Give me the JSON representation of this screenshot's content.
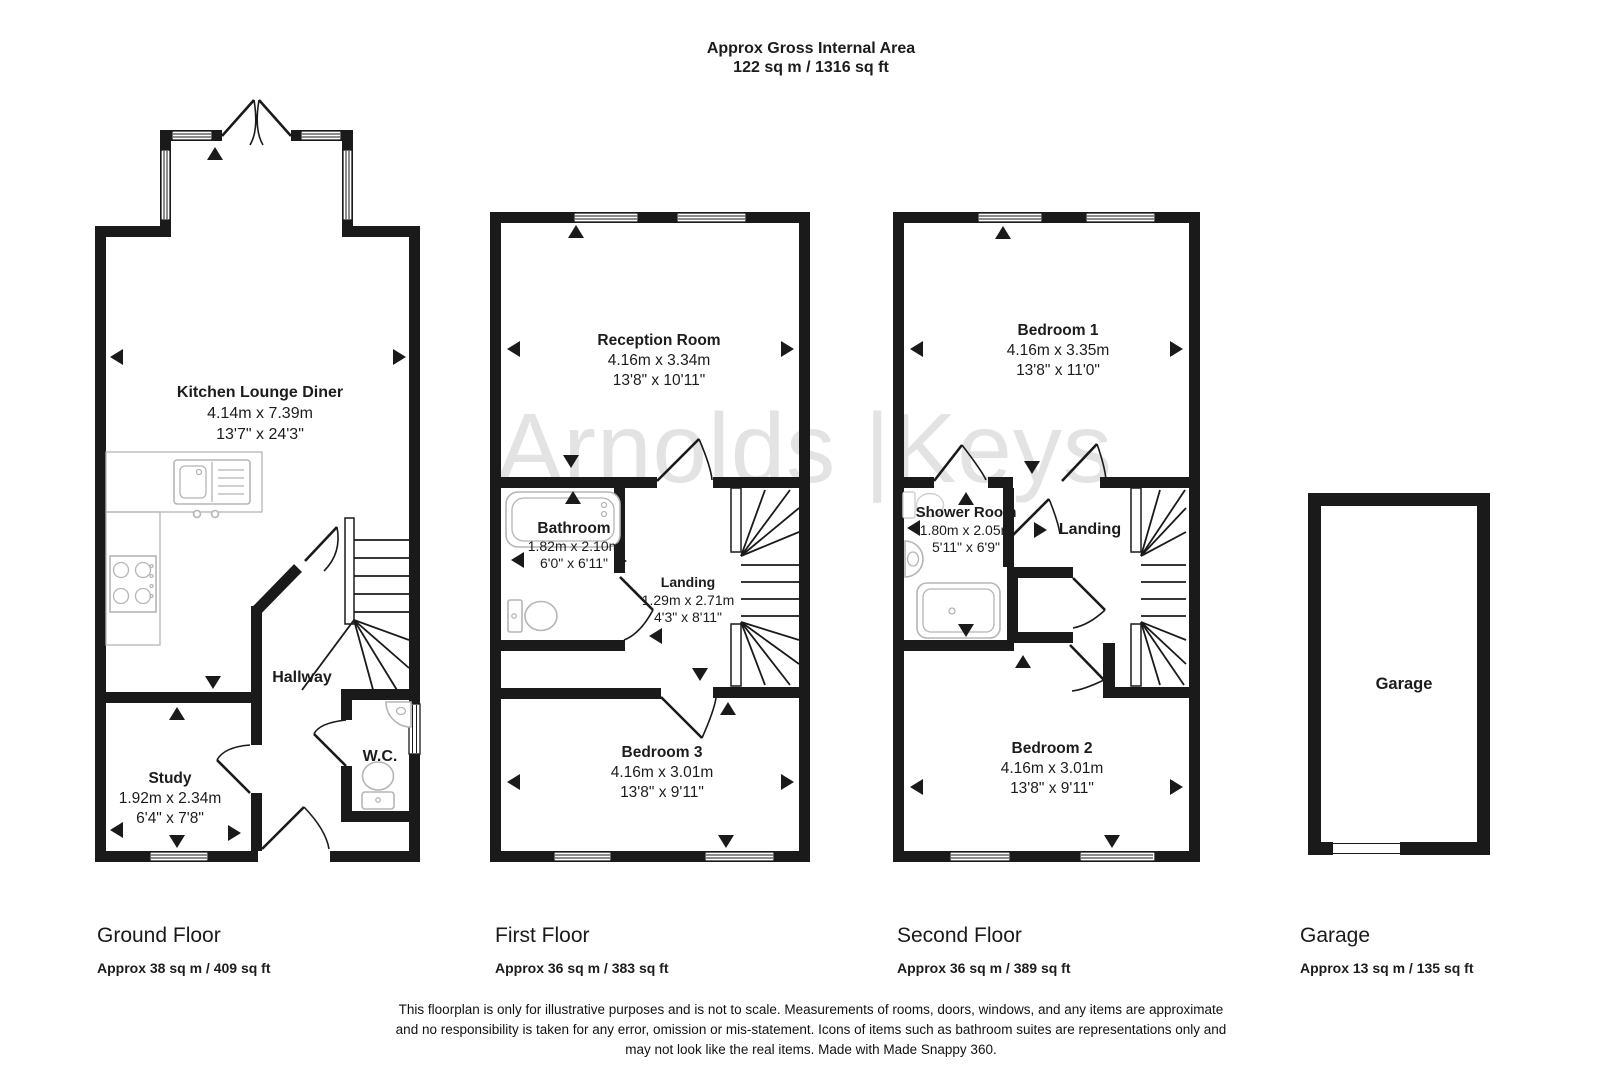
{
  "header": {
    "title_line1": "Approx Gross Internal Area",
    "title_line2": "122 sq m / 1316 sq ft"
  },
  "watermark": {
    "text": "Arnolds |Keys"
  },
  "floors": {
    "ground": {
      "caption": "Ground Floor",
      "area": "Approx 38 sq m / 409 sq ft",
      "rooms": {
        "kitchen": {
          "name": "Kitchen Lounge Diner",
          "metric": "4.14m x 7.39m",
          "imperial": "13'7\" x 24'3\""
        },
        "hallway": {
          "name": "Hallway"
        },
        "study": {
          "name": "Study",
          "metric": "1.92m x 2.34m",
          "imperial": "6'4\" x 7'8\""
        },
        "wc": {
          "name": "W.C."
        }
      }
    },
    "first": {
      "caption": "First Floor",
      "area": "Approx 36 sq m / 383 sq ft",
      "rooms": {
        "reception": {
          "name": "Reception Room",
          "metric": "4.16m x 3.34m",
          "imperial": "13'8\" x 10'11\""
        },
        "bathroom": {
          "name": "Bathroom",
          "metric": "1.82m x 2.10m",
          "imperial": "6'0\" x 6'11\""
        },
        "landing": {
          "name": "Landing",
          "metric": "1.29m x 2.71m",
          "imperial": "4'3\" x 8'11\""
        },
        "bedroom3": {
          "name": "Bedroom 3",
          "metric": "4.16m x 3.01m",
          "imperial": "13'8\" x 9'11\""
        }
      }
    },
    "second": {
      "caption": "Second Floor",
      "area": "Approx 36 sq m / 389 sq ft",
      "rooms": {
        "bedroom1": {
          "name": "Bedroom 1",
          "metric": "4.16m x 3.35m",
          "imperial": "13'8\" x 11'0\""
        },
        "shower": {
          "name": "Shower Room",
          "metric": "1.80m x 2.05m",
          "imperial": "5'11\" x 6'9\""
        },
        "landing": {
          "name": "Landing"
        },
        "bedroom2": {
          "name": "Bedroom 2",
          "metric": "4.16m x 3.01m",
          "imperial": "13'8\" x 9'11\""
        }
      }
    },
    "garage": {
      "caption": "Garage",
      "area": "Approx 13 sq m / 135 sq ft",
      "rooms": {
        "garage": {
          "name": "Garage"
        }
      }
    }
  },
  "footer": {
    "line1": "This floorplan is only for illustrative purposes and is not to scale. Measurements of rooms, doors, windows, and any items are approximate",
    "line2": "and no responsibility is taken for any error, omission or mis-statement. Icons of items such as bathroom suites are representations only and",
    "line3": "may not look like the real items. Made with Made Snappy 360."
  },
  "colors": {
    "wall": "#1a1a1a",
    "watermark": "#e3e3e3",
    "fixture": "#b5b5b5"
  }
}
